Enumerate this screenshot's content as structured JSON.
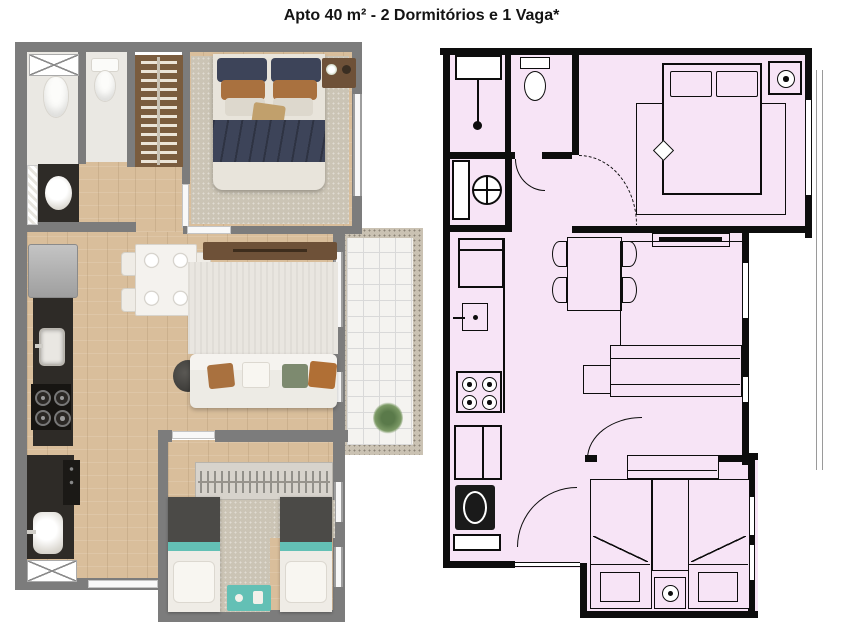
{
  "title": "Apto 40 m² - 2 Dormitórios e 1 Vaga*",
  "plans": {
    "left": {
      "style": "3d-rendered-top-view",
      "rooms": [
        "bathroom",
        "master-bedroom",
        "kitchen",
        "dining-living",
        "balcony",
        "second-bedroom",
        "laundry"
      ]
    },
    "right": {
      "style": "technical-line-drawing",
      "rooms": [
        "bathroom",
        "master-bedroom",
        "kitchen",
        "dining-living",
        "balcony",
        "second-bedroom",
        "laundry"
      ]
    }
  },
  "colors": {
    "background": "#ffffff",
    "title_text": "#141414",
    "wall_gray": "#7c7c7c",
    "wall_black": "#0d0d0d",
    "plan_pink": "#f7e4f6",
    "wood_floor": "#d9be9b",
    "tile_white": "#eae8e3",
    "rug_beige": "#cbc4b5",
    "rug_cream": "#e9e6e0",
    "counter_dark": "#2e2b27",
    "bed_navy": "#3d4459",
    "pillow_brown": "#a9713f",
    "pillow_green": "#7d8a6f",
    "pillow_orange": "#b06f35",
    "teal_accent": "#63c0b5",
    "blanket_gray": "#4b4a47",
    "furniture_brown": "#6e5138",
    "wardrobe_brown": "#7a5c3e",
    "appliance_gray": "#b9b9b9",
    "plant_green": "#5a7a4a",
    "balcony_border": "#cac2b3",
    "balcony_tile": "#f4f3f0",
    "grid_line": "#d9d9d9"
  }
}
